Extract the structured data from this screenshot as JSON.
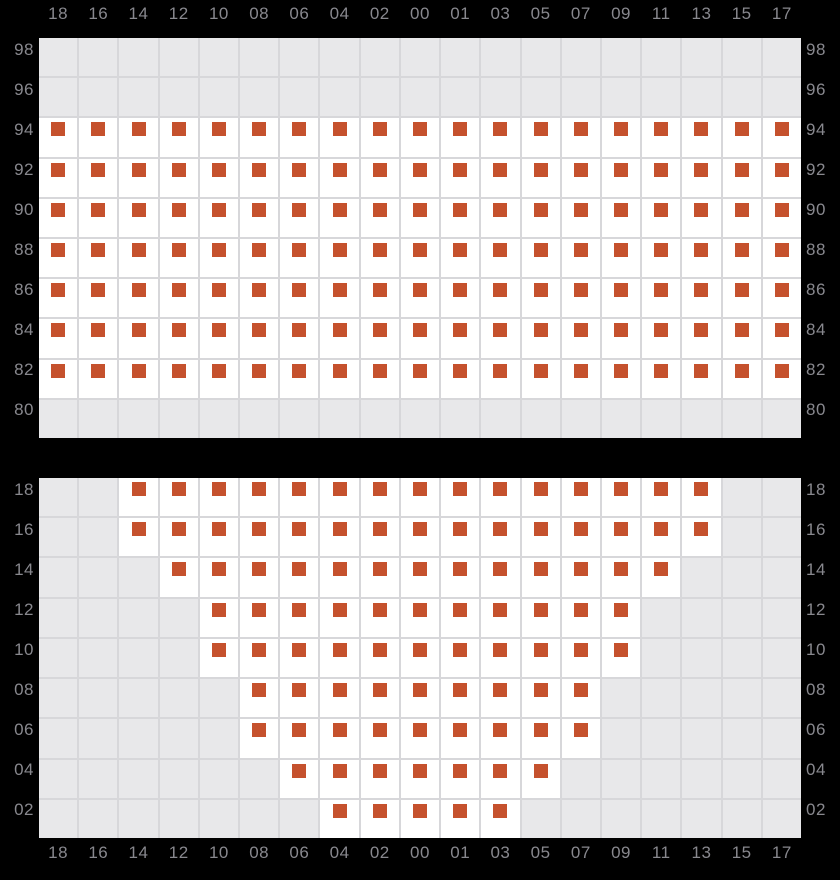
{
  "colors": {
    "background": "#000000",
    "marker": "#c5512d",
    "cell_available": "#ffffff",
    "cell_unavailable": "#e8e8ea",
    "gridline": "#d7d7da",
    "axis_label": "#88888e"
  },
  "chart_data": [
    {
      "type": "heatmap",
      "title": "",
      "xlabel": "",
      "ylabel": "",
      "legend": "none",
      "grid": "on",
      "marker_shape": "square",
      "cell_meaning": {
        "0": "empty-gray-cell",
        "1": "white-cell-with-orange-marker"
      },
      "x_categories": [
        "18",
        "16",
        "14",
        "12",
        "10",
        "08",
        "06",
        "04",
        "02",
        "00",
        "01",
        "03",
        "05",
        "07",
        "09",
        "11",
        "13",
        "15",
        "17"
      ],
      "y_categories": [
        "98",
        "96",
        "94",
        "92",
        "90",
        "88",
        "86",
        "84",
        "82",
        "80"
      ],
      "rows": [
        {
          "y": "98",
          "cells": [
            0,
            0,
            0,
            0,
            0,
            0,
            0,
            0,
            0,
            0,
            0,
            0,
            0,
            0,
            0,
            0,
            0,
            0,
            0
          ]
        },
        {
          "y": "96",
          "cells": [
            0,
            0,
            0,
            0,
            0,
            0,
            0,
            0,
            0,
            0,
            0,
            0,
            0,
            0,
            0,
            0,
            0,
            0,
            0
          ]
        },
        {
          "y": "94",
          "cells": [
            1,
            1,
            1,
            1,
            1,
            1,
            1,
            1,
            1,
            1,
            1,
            1,
            1,
            1,
            1,
            1,
            1,
            1,
            1
          ]
        },
        {
          "y": "92",
          "cells": [
            1,
            1,
            1,
            1,
            1,
            1,
            1,
            1,
            1,
            1,
            1,
            1,
            1,
            1,
            1,
            1,
            1,
            1,
            1
          ]
        },
        {
          "y": "90",
          "cells": [
            1,
            1,
            1,
            1,
            1,
            1,
            1,
            1,
            1,
            1,
            1,
            1,
            1,
            1,
            1,
            1,
            1,
            1,
            1
          ]
        },
        {
          "y": "88",
          "cells": [
            1,
            1,
            1,
            1,
            1,
            1,
            1,
            1,
            1,
            1,
            1,
            1,
            1,
            1,
            1,
            1,
            1,
            1,
            1
          ]
        },
        {
          "y": "86",
          "cells": [
            1,
            1,
            1,
            1,
            1,
            1,
            1,
            1,
            1,
            1,
            1,
            1,
            1,
            1,
            1,
            1,
            1,
            1,
            1
          ]
        },
        {
          "y": "84",
          "cells": [
            1,
            1,
            1,
            1,
            1,
            1,
            1,
            1,
            1,
            1,
            1,
            1,
            1,
            1,
            1,
            1,
            1,
            1,
            1
          ]
        },
        {
          "y": "82",
          "cells": [
            1,
            1,
            1,
            1,
            1,
            1,
            1,
            1,
            1,
            1,
            1,
            1,
            1,
            1,
            1,
            1,
            1,
            1,
            1
          ]
        },
        {
          "y": "80",
          "cells": [
            0,
            0,
            0,
            0,
            0,
            0,
            0,
            0,
            0,
            0,
            0,
            0,
            0,
            0,
            0,
            0,
            0,
            0,
            0
          ]
        }
      ]
    },
    {
      "type": "heatmap",
      "title": "",
      "xlabel": "",
      "ylabel": "",
      "legend": "none",
      "grid": "on",
      "marker_shape": "square",
      "cell_meaning": {
        "0": "empty-gray-cell",
        "1": "white-cell-with-orange-marker"
      },
      "x_categories": [
        "18",
        "16",
        "14",
        "12",
        "10",
        "08",
        "06",
        "04",
        "02",
        "00",
        "01",
        "03",
        "05",
        "07",
        "09",
        "11",
        "13",
        "15",
        "17"
      ],
      "y_categories": [
        "18",
        "16",
        "14",
        "12",
        "10",
        "08",
        "06",
        "04",
        "02"
      ],
      "rows": [
        {
          "y": "18",
          "cells": [
            0,
            0,
            1,
            1,
            1,
            1,
            1,
            1,
            1,
            1,
            1,
            1,
            1,
            1,
            1,
            1,
            1,
            0,
            0
          ]
        },
        {
          "y": "16",
          "cells": [
            0,
            0,
            1,
            1,
            1,
            1,
            1,
            1,
            1,
            1,
            1,
            1,
            1,
            1,
            1,
            1,
            1,
            0,
            0
          ]
        },
        {
          "y": "14",
          "cells": [
            0,
            0,
            0,
            1,
            1,
            1,
            1,
            1,
            1,
            1,
            1,
            1,
            1,
            1,
            1,
            1,
            0,
            0,
            0
          ]
        },
        {
          "y": "12",
          "cells": [
            0,
            0,
            0,
            0,
            1,
            1,
            1,
            1,
            1,
            1,
            1,
            1,
            1,
            1,
            1,
            0,
            0,
            0,
            0
          ]
        },
        {
          "y": "10",
          "cells": [
            0,
            0,
            0,
            0,
            1,
            1,
            1,
            1,
            1,
            1,
            1,
            1,
            1,
            1,
            1,
            0,
            0,
            0,
            0
          ]
        },
        {
          "y": "08",
          "cells": [
            0,
            0,
            0,
            0,
            0,
            1,
            1,
            1,
            1,
            1,
            1,
            1,
            1,
            1,
            0,
            0,
            0,
            0,
            0
          ]
        },
        {
          "y": "06",
          "cells": [
            0,
            0,
            0,
            0,
            0,
            1,
            1,
            1,
            1,
            1,
            1,
            1,
            1,
            1,
            0,
            0,
            0,
            0,
            0
          ]
        },
        {
          "y": "04",
          "cells": [
            0,
            0,
            0,
            0,
            0,
            0,
            1,
            1,
            1,
            1,
            1,
            1,
            1,
            0,
            0,
            0,
            0,
            0,
            0
          ]
        },
        {
          "y": "02",
          "cells": [
            0,
            0,
            0,
            0,
            0,
            0,
            0,
            1,
            1,
            1,
            1,
            1,
            0,
            0,
            0,
            0,
            0,
            0,
            0
          ]
        }
      ]
    }
  ],
  "layout_values": {
    "top_axis_y": 4,
    "top_chart_y": 38,
    "top_chart_height": 400,
    "bottom_chart_y": 478,
    "bottom_chart_height": 360,
    "bottom_axis_y": 843
  }
}
